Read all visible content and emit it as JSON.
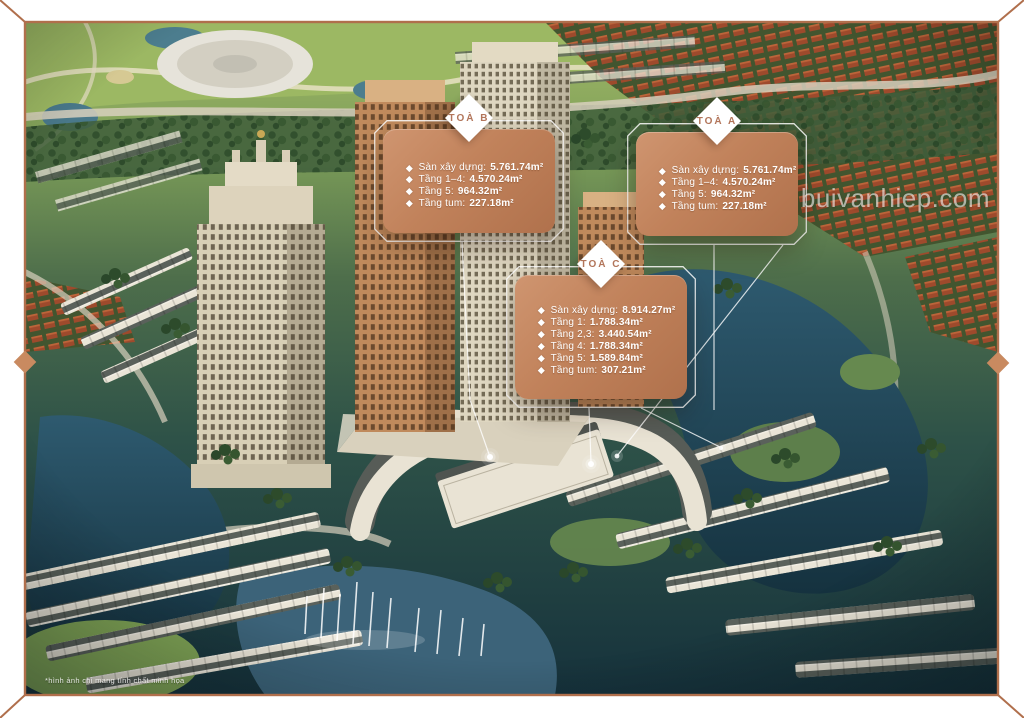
{
  "page": {
    "watermark": "buivanhiep.com",
    "disclaimer": "*hình ảnh chỉ mang tính chất minh họa"
  },
  "callouts": {
    "b": {
      "title": "TOÀ B",
      "rows": [
        {
          "label": "Sàn xây dựng:",
          "value": "5.761.74m²"
        },
        {
          "label": "Tầng 1–4:",
          "value": "4.570.24m²"
        },
        {
          "label": "Tầng 5:",
          "value": "964.32m²"
        },
        {
          "label": "Tầng tum:",
          "value": "227.18m²"
        }
      ]
    },
    "a": {
      "title": "TOÀ A",
      "rows": [
        {
          "label": "Sàn xây dựng:",
          "value": "5.761.74m²"
        },
        {
          "label": "Tầng 1–4:",
          "value": "4.570.24m²"
        },
        {
          "label": "Tầng 5:",
          "value": "964.32m²"
        },
        {
          "label": "Tầng tum:",
          "value": "227.18m²"
        }
      ]
    },
    "c": {
      "title": "TOÀ C",
      "rows": [
        {
          "label": "Sàn xây dựng:",
          "value": "8.914.27m²"
        },
        {
          "label": "Tầng 1:",
          "value": "1.788.34m²"
        },
        {
          "label": "Tầng 2,3:",
          "value": "3.440.54m²"
        },
        {
          "label": "Tầng 4:",
          "value": "1.788.34m²"
        },
        {
          "label": "Tầng 5:",
          "value": "1.589.84m²"
        },
        {
          "label": "Tầng tum:",
          "value": "307.21m²"
        }
      ]
    }
  },
  "colors": {
    "frame_border": "#b06f4c",
    "frame_diamond": "#c98a60",
    "callout_gradient_start": "#cf9570",
    "callout_gradient_end": "#b0714c",
    "callout_title": "#b2755a",
    "water_dark": "#1a3a4a",
    "golf_green": "#9cb863",
    "red_roofs": "#9e4a2c",
    "tower_cream": "#d8cfb6",
    "tower_copper": "#c08a5c"
  }
}
